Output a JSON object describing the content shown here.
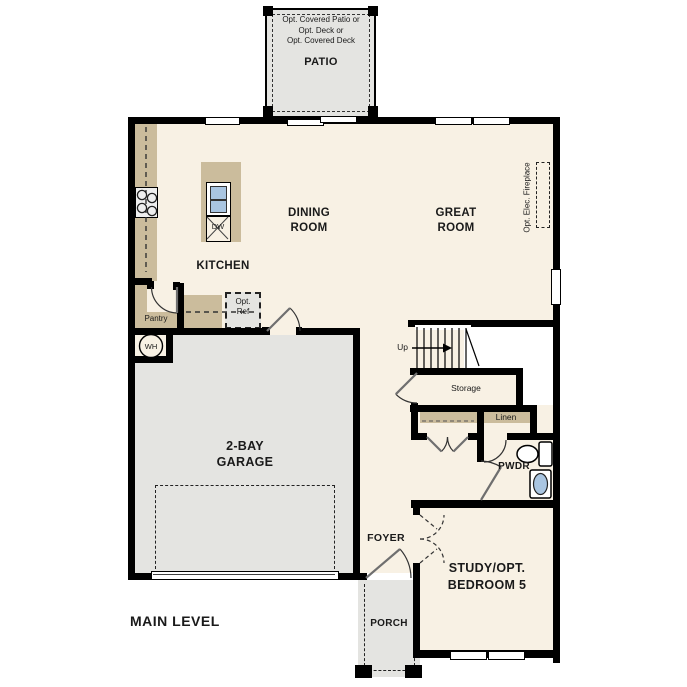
{
  "labels": {
    "patio_note_1": "Opt. Covered Patio or",
    "patio_note_2": "Opt. Deck or",
    "patio_note_3": "Opt. Covered Deck",
    "patio": "PATIO",
    "dining_1": "DINING",
    "dining_2": "ROOM",
    "great_1": "GREAT",
    "great_2": "ROOM",
    "kitchen": "KITCHEN",
    "fireplace": "Opt. Elec. Fireplace",
    "pantry": "Pantry",
    "opt_ref_1": "Opt.",
    "opt_ref_2": "Ref",
    "wh": "WH",
    "dw": "DW",
    "garage_1": "2-BAY",
    "garage_2": "GARAGE",
    "up": "Up",
    "storage": "Storage",
    "linen": "Linen",
    "pwdr": "PWDR",
    "foyer": "FOYER",
    "study_1": "STUDY/OPT.",
    "study_2": "BEDROOM 5",
    "porch": "PORCH",
    "main_level": "MAIN LEVEL"
  },
  "colors": {
    "floor_beige": "#f8f1e4",
    "hardscape_gray": "#e4e4e1",
    "counter_tan": "#cbbc9c",
    "wall_black": "#000000",
    "sink_blue": "#a9c5e1"
  }
}
